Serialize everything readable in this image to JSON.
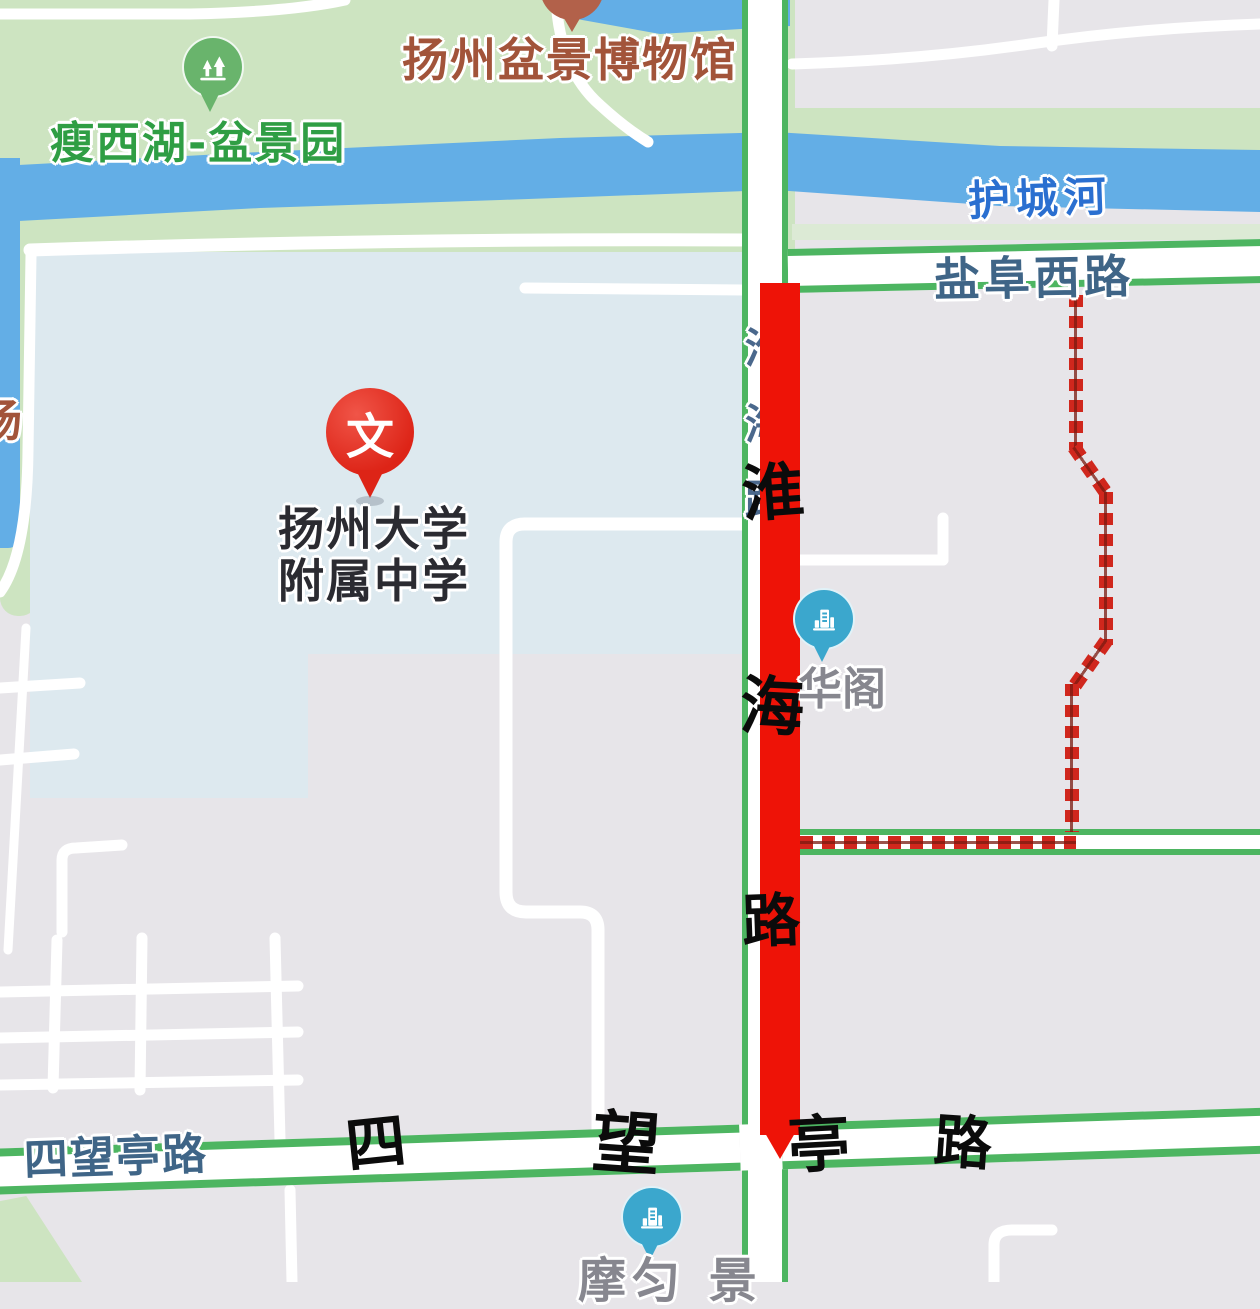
{
  "poi": {
    "park": {
      "label": "瘦西湖-盆景园"
    },
    "museum": {
      "label": "扬州盆景博物馆"
    },
    "school": {
      "line1": "扬州大学",
      "line2": "附属中学",
      "pin_char": "文"
    },
    "huage": {
      "label": "华阁"
    },
    "bottom_poi": {
      "label_partial": "摩匀 景"
    },
    "left_edge_partial": "场"
  },
  "roads": {
    "yanfu_west": "盐阜西路",
    "siwangting": "四望亭路",
    "huaihai_small": "淮海路"
  },
  "water": {
    "moat": "护城河"
  },
  "overlay": {
    "vertical_road_chars": [
      "淮",
      "海",
      "路"
    ],
    "horizontal_road_chars": [
      "四",
      "望",
      "亭",
      "路"
    ]
  },
  "icons": {
    "park_marker": "trees-icon",
    "museum_marker": "museum-pin-icon",
    "school_marker": "wen-pin-icon",
    "huage_marker": "building-icon",
    "bottom_marker": "building-icon"
  },
  "colors": {
    "route_red": "#ee1307",
    "dash_red": "#d0271d",
    "road_edge_green": "#4db561",
    "water_blue": "#63aee6",
    "park_green": "#cde4c1",
    "campus_blue": "#dde9ef",
    "block_gray": "#e7e5e9",
    "label_green": "#2f9e44",
    "label_brown": "#a2543a",
    "label_blue": "#2a6fd0",
    "label_slate": "#3f6587",
    "poi_gray": "#87878f",
    "ink_black": "#0b0b0b",
    "marker_blue": "#3ba7cd",
    "marker_green": "#69b46c",
    "marker_maroon": "#b2614a",
    "pin_red": "#dd2417"
  }
}
